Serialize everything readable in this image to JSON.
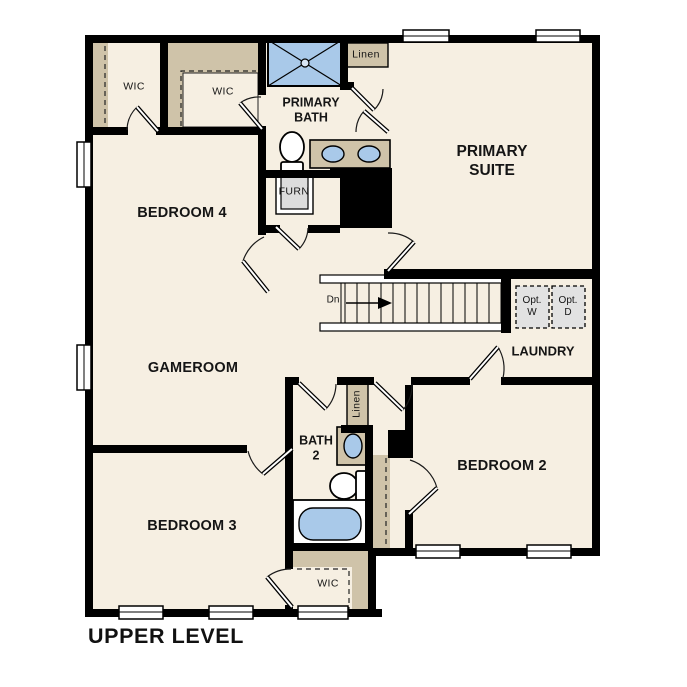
{
  "plan": {
    "title": "UPPER LEVEL",
    "rooms": {
      "primary_suite": {
        "line1": "PRIMARY",
        "line2": "SUITE"
      },
      "primary_bath": {
        "line1": "PRIMARY",
        "line2": "BATH"
      },
      "bedroom_2": {
        "label": "BEDROOM 2"
      },
      "bedroom_3": {
        "label": "BEDROOM 3"
      },
      "bedroom_4": {
        "label": "BEDROOM 4"
      },
      "gameroom": {
        "label": "GAMEROOM"
      },
      "laundry": {
        "label": "LAUNDRY"
      },
      "bath_2": {
        "line1": "BATH",
        "line2": "2"
      },
      "wic_top_left": {
        "label": "WIC"
      },
      "wic_top_mid": {
        "label": "WIC"
      },
      "wic_bottom": {
        "label": "WIC"
      },
      "linen_top": {
        "label": "Linen"
      },
      "linen_mid": {
        "label": "Linen"
      },
      "furnace": {
        "label": "FURN"
      }
    },
    "stairs": {
      "direction_label": "Dn"
    },
    "laundry_appliances": {
      "washer": {
        "line1": "Opt.",
        "line2": "W"
      },
      "dryer": {
        "line1": "Opt.",
        "line2": "D"
      }
    },
    "colors": {
      "background": "#ffffff",
      "floor": "#f6efe2",
      "wall": "#000000",
      "shelving_tan": "#cfc3a9",
      "fixture_blue": "#a9c9e9",
      "appliance_gray": "#e2e2e2",
      "furnace_gray": "#dcdcdc"
    }
  }
}
